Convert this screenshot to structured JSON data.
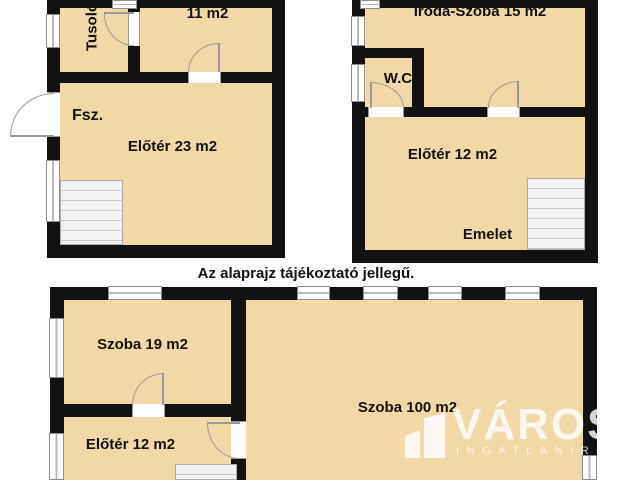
{
  "disclaimer": "Az alaprajz tájékoztató jellegű.",
  "plans": {
    "ground": {
      "floor_label": "Fsz.",
      "room_tusolo": "Tusoló",
      "room_konyha_name": "Étkező-Konyha",
      "room_konyha_area": "11 m2",
      "room_eloter": "Előtér 23 m2"
    },
    "upper": {
      "floor_label": "Emelet",
      "room_iroda": "Iroda-Szoba 15 m2",
      "room_wc": "W.C.",
      "room_eloter": "Előtér 12 m2"
    },
    "attic": {
      "room_szoba19": "Szoba 19 m2",
      "room_eloter": "Előtér 12 m2",
      "room_szoba100": "Szoba 100 m2"
    }
  },
  "watermark": {
    "brand": "VÁROS",
    "subtitle": "INGATLANIRODA",
    "icon": "buildings-icon"
  },
  "colors": {
    "room_fill": "#f1d8a6",
    "wall": "#121212",
    "watermark": "#ffffff",
    "text": "#111111"
  }
}
